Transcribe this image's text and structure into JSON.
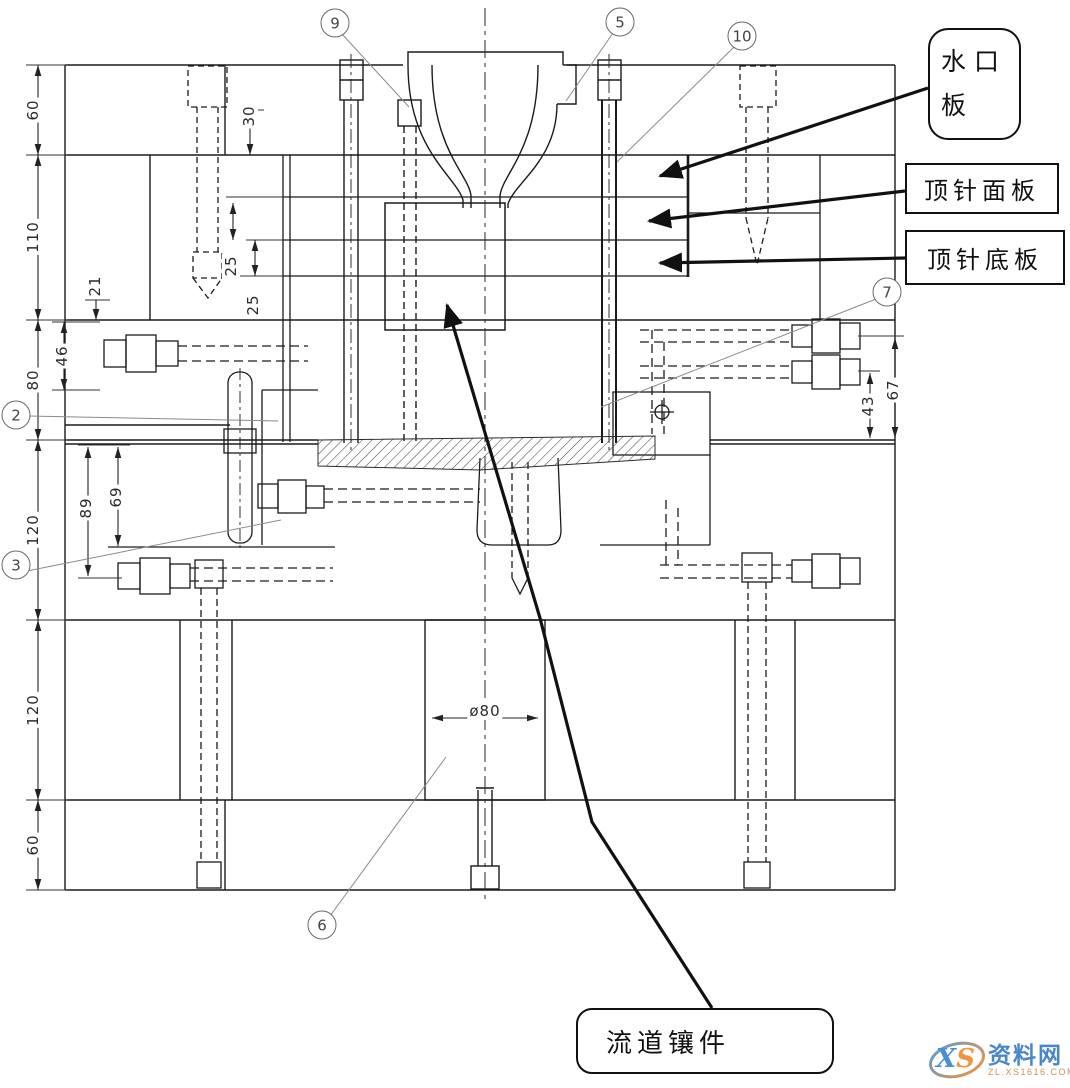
{
  "drawing": {
    "kind": "injection-mold-assembly-section",
    "labels": {
      "water_gate_plate": "水口板",
      "ejector_face_plate": "顶针面板",
      "ejector_bottom_plate": "顶针底板",
      "runner_insert": "流道镶件"
    },
    "balloons": [
      {
        "num": "9"
      },
      {
        "num": "5"
      },
      {
        "num": "10"
      },
      {
        "num": "2"
      },
      {
        "num": "3"
      },
      {
        "num": "7"
      },
      {
        "num": "6"
      }
    ],
    "dimensions": {
      "left_chain": [
        "60",
        "110",
        "80",
        "120",
        "120",
        "60"
      ],
      "d30": "30",
      "d21": "21",
      "d46": "46",
      "d25a": "25",
      "d25b": "25",
      "d89": "89",
      "d69": "69",
      "d43": "43",
      "d67": "67",
      "dia80": "ø80"
    }
  },
  "watermark": {
    "logo_x": "X",
    "logo_s": "S",
    "site": "资料网",
    "url": "ZL.XS1616.COM"
  }
}
